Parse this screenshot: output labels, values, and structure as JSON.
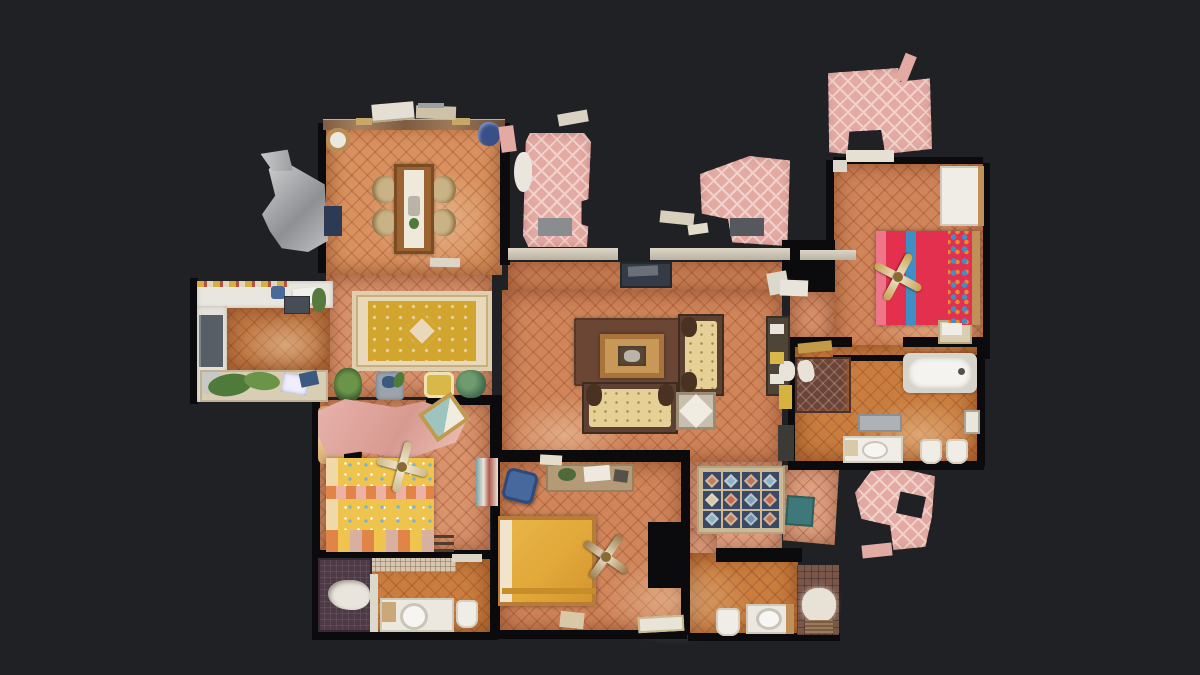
{
  "scene": {
    "title": "apartment-dollhouse-floorplan-scan",
    "background": "#1f2125"
  },
  "palette": {
    "bg": "#1f2125",
    "wall": "#0b0b0d",
    "terra": "#d0855a",
    "terra-light": "#d9925f",
    "terra-deep": "#c07a45",
    "orange": "#c97e3f",
    "salmon": "#d8926c",
    "salmon-pink": "#e0a183",
    "tile-line": "rgba(125,52,22,0.24)",
    "terrace-pink": "#e3aaa4",
    "terrace-lattice": "#f1d2cb",
    "white": "#efede6",
    "counter": "#e9e6df",
    "wood": "#9a6331",
    "wood-dark": "#5c4132",
    "wood-light": "#c09058",
    "rug-cream": "#e9d8ba",
    "rug-gold": "#d2a62e",
    "rug-brown": "#6b4634",
    "rug-border": "#cbb894",
    "sofa": "#e6d096",
    "bed-red": "#e2304e",
    "bed-red-light": "#ef7688",
    "bed-blue-stripe": "#3f8ec4",
    "bed-gold": "#e2a83a",
    "bed-yellow": "#eec44e",
    "check-orange": "#e08448",
    "check-pink": "#eeb2a2",
    "teal": "#3e7878",
    "shower-brown": "#6a4438",
    "shower-purple": "#4e3a46",
    "tile-wall-brown": "#7a564a",
    "fan-gold": "#c8a050",
    "curtain": "#c3c4c6",
    "console-dark": "#353b46",
    "mirror": "#aeb2b6",
    "green": "#4e7a3a",
    "green-light": "#6a9448",
    "chair-blue": "#46689c",
    "chair-tan": "#c9b386"
  },
  "rooms": [
    {
      "name": "dining-room"
    },
    {
      "name": "kitchen"
    },
    {
      "name": "living-room"
    },
    {
      "name": "hallway"
    },
    {
      "name": "master-bedroom"
    },
    {
      "name": "yellow-bedroom"
    },
    {
      "name": "gold-bedroom"
    },
    {
      "name": "main-bathroom"
    },
    {
      "name": "left-bathroom"
    },
    {
      "name": "middle-bathroom"
    },
    {
      "name": "terrace"
    }
  ],
  "ornate_rug": {
    "border": "#cbb894",
    "field": "#3a4a66",
    "cells": [
      "#c08060",
      "#8fb0cc",
      "#b9765a",
      "#8fb0cc",
      "#d8c8a8",
      "#c06a50",
      "#7f9ec0",
      "#c06a50",
      "#8fb0cc",
      "#c08060",
      "#6f92b4",
      "#b9765a"
    ]
  }
}
